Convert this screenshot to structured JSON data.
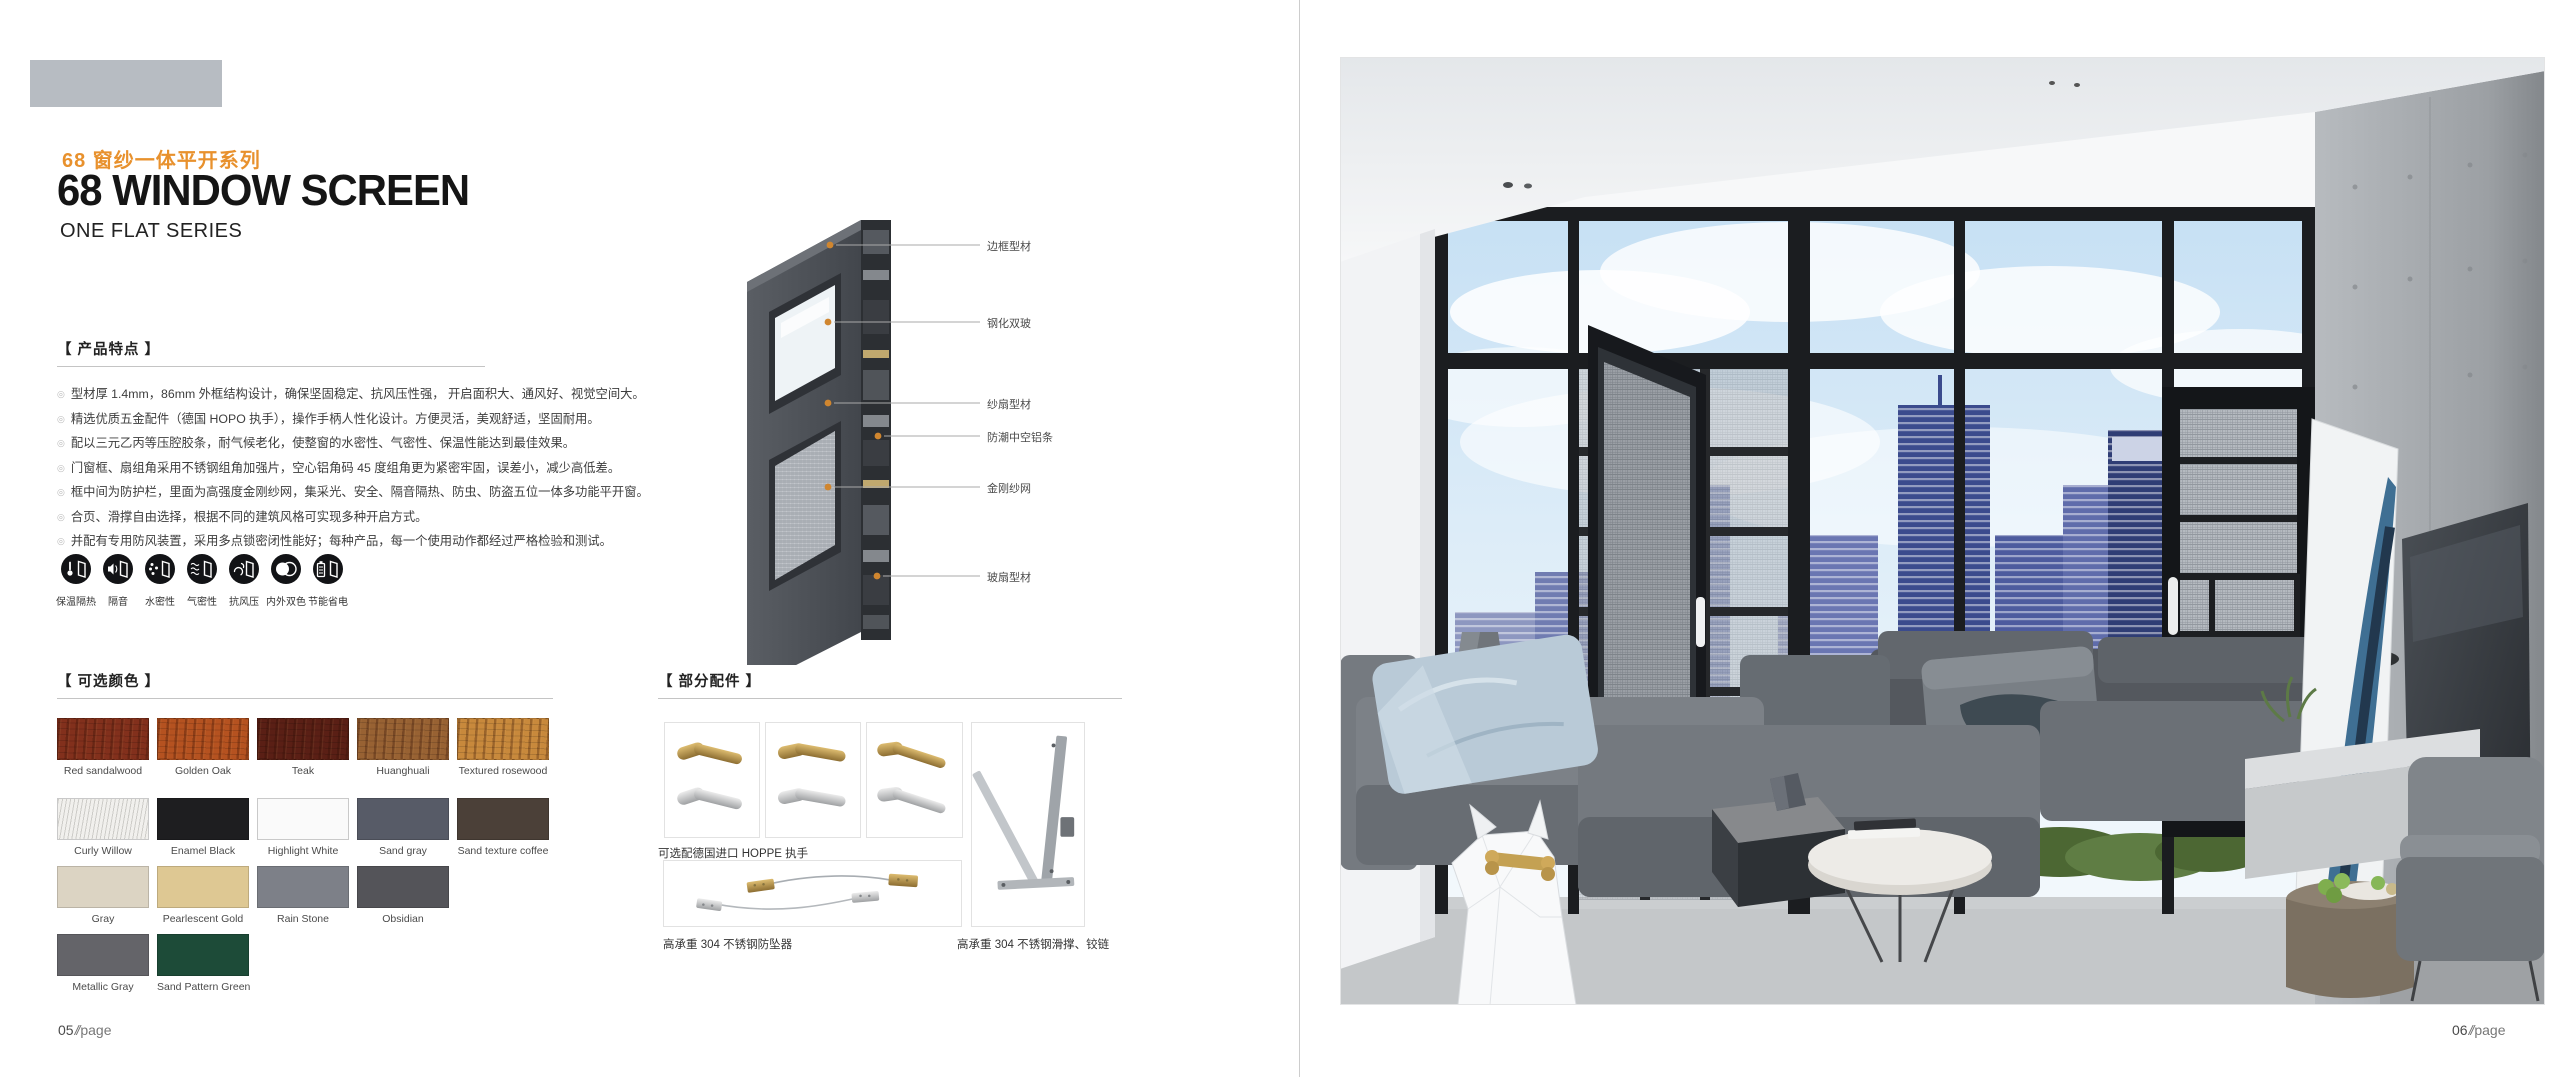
{
  "theme": {
    "accent_orange": "#e8912d",
    "ink": "#151515",
    "header_block_gray": "#b7bcc2"
  },
  "left_page": {
    "page_number": "05",
    "page_sep": "//",
    "page_word": "page",
    "series_title_cn": "68 窗纱一体平开系列",
    "series_title_en": "68 WINDOW SCREEN",
    "series_subtitle_en": "ONE FLAT SERIES",
    "features": {
      "heading": "【 产品特点 】",
      "items": [
        "型材厚 1.4mm，86mm 外框结构设计，确保坚固稳定、抗风压性强， 开启面积大、通风好、视觉空间大。",
        "精选优质五金配件（德国 HOPO 执手），操作手柄人性化设计。方便灵活，美观舒适，坚固耐用。",
        "配以三元乙丙等压腔胶条，耐气候老化，使整窗的水密性、气密性、保温性能达到最佳效果。",
        "门窗框、扇组角采用不锈钢组角加强片，空心铝角码 45 度组角更为紧密牢固，误差小，减少高低差。",
        "框中间为防护栏，里面为高强度金刚纱网，集采光、安全、隔音隔热、防虫、防盗五位一体多功能平开窗。",
        "合页、滑撑自由选择，根据不同的建筑风格可实现多种开启方式。",
        "并配有专用防风装置，采用多点锁密闭性能好；每种产品，每一个使用动作都经过严格检验和测试。"
      ]
    },
    "feature_icons": [
      {
        "name": "thermal-insulation",
        "label": "保温隔热"
      },
      {
        "name": "sound-insulation",
        "label": "隔音"
      },
      {
        "name": "water-tightness",
        "label": "水密性"
      },
      {
        "name": "air-tightness",
        "label": "气密性"
      },
      {
        "name": "wind-pressure-resistance",
        "label": "抗风压"
      },
      {
        "name": "dual-color",
        "label": "内外双色"
      },
      {
        "name": "energy-saving",
        "label": "节能省电"
      }
    ],
    "diagram_callouts": [
      "边框型材",
      "钢化双玻",
      "纱扇型材",
      "防潮中空铝条",
      "金刚纱网",
      "玻扇型材"
    ],
    "colors": {
      "heading": "【 可选颜色 】",
      "swatches": [
        {
          "label": "Red sandalwood",
          "hex": "#82301c",
          "wood": true
        },
        {
          "label": "Golden Oak",
          "hex": "#b55220",
          "wood": true
        },
        {
          "label": "Teak",
          "hex": "#5a1f15",
          "wood": true
        },
        {
          "label": "Huanghuali",
          "hex": "#986233",
          "wood": true
        },
        {
          "label": "Textured rosewood",
          "hex": "#c8893c",
          "wood": true
        },
        {
          "label": "Curly Willow",
          "hex": "#f1f0ed",
          "textured": true,
          "light": true
        },
        {
          "label": "Enamel Black",
          "hex": "#1e1e20"
        },
        {
          "label": "Highlight White",
          "hex": "#fafafa",
          "light": true
        },
        {
          "label": "Sand gray",
          "hex": "#575b67"
        },
        {
          "label": "Sand texture coffee",
          "hex": "#4b4038"
        },
        {
          "label": "Gray",
          "hex": "#dcd4c3"
        },
        {
          "label": "Pearlescent Gold",
          "hex": "#dec893"
        },
        {
          "label": "Rain Stone",
          "hex": "#7d8088"
        },
        {
          "label": "Obsidian",
          "hex": "#545459"
        },
        {
          "label": "Metallic Gray",
          "hex": "#646469"
        },
        {
          "label": "Sand Pattern Green",
          "hex": "#1d4b38"
        }
      ]
    },
    "accessories": {
      "heading": "【 部分配件 】",
      "handles_caption": "可选配德国进口 HOPPE 执手",
      "antifall_caption": "高承重 304 不锈钢防坠器",
      "hinge_caption": "高承重 304 不锈钢滑撑、铰链"
    }
  },
  "right_page": {
    "page_number": "06",
    "page_sep": "//",
    "page_word": "page"
  }
}
